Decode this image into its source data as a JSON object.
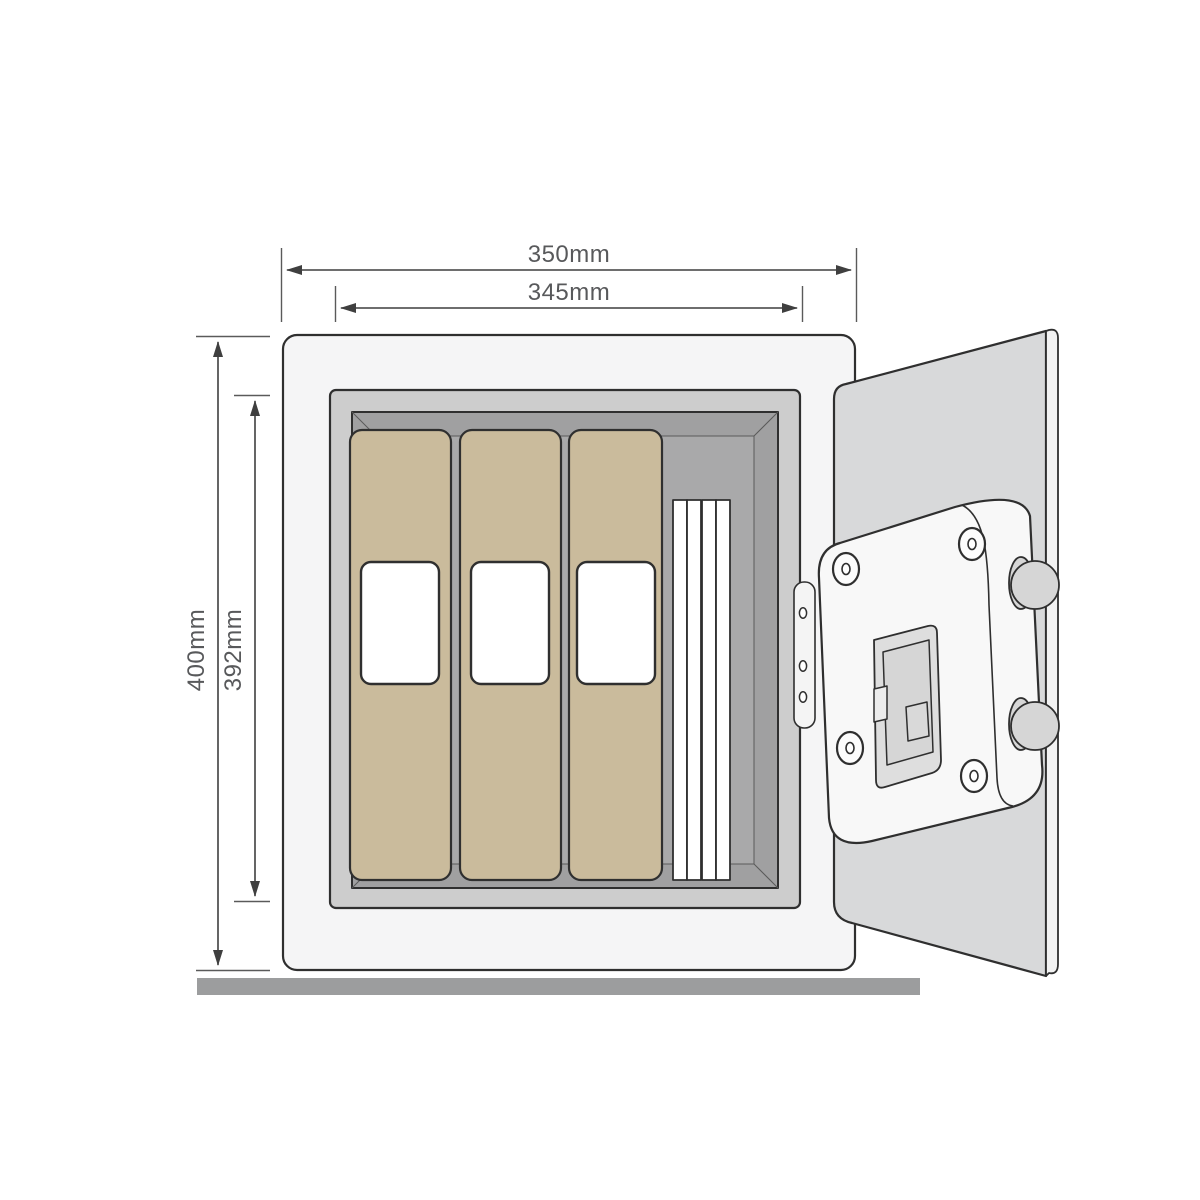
{
  "labels": {
    "outer_width": "350mm",
    "inner_width": "345mm",
    "outer_height": "400mm",
    "inner_height": "392mm"
  },
  "diagram": {
    "type": "product-dimension-drawing",
    "subject": "open safe with binders, hinged door, lock plate and locking bolts",
    "dimensions": [
      {
        "name": "outer width",
        "value": "350mm",
        "orientation": "horizontal"
      },
      {
        "name": "inner width",
        "value": "345mm",
        "orientation": "horizontal"
      },
      {
        "name": "outer height",
        "value": "400mm",
        "orientation": "vertical"
      },
      {
        "name": "inner height",
        "value": "392mm",
        "orientation": "vertical"
      }
    ]
  },
  "colors": {
    "outline": "#2f2f2f",
    "dimension_line": "#3f3f3f",
    "label_text": "#58595b",
    "safe_body": "#f5f5f6",
    "frame": "#cdcdcd",
    "interior": "#a0a0a1",
    "interior_back": "#a9a9aa",
    "binder": "#cabb9c",
    "binder_label": "#ffffff",
    "paper": "#ffffff",
    "door": "#d8d9da",
    "door_edge": "#f2f2f2",
    "hinge": "#f4f4f4",
    "lock_plate": "#f8f8f8",
    "battery_panel": "#dedede",
    "battery_inner": "#d6d6d6",
    "bolt": "#d6d6d6",
    "ground": "#9c9d9e"
  }
}
